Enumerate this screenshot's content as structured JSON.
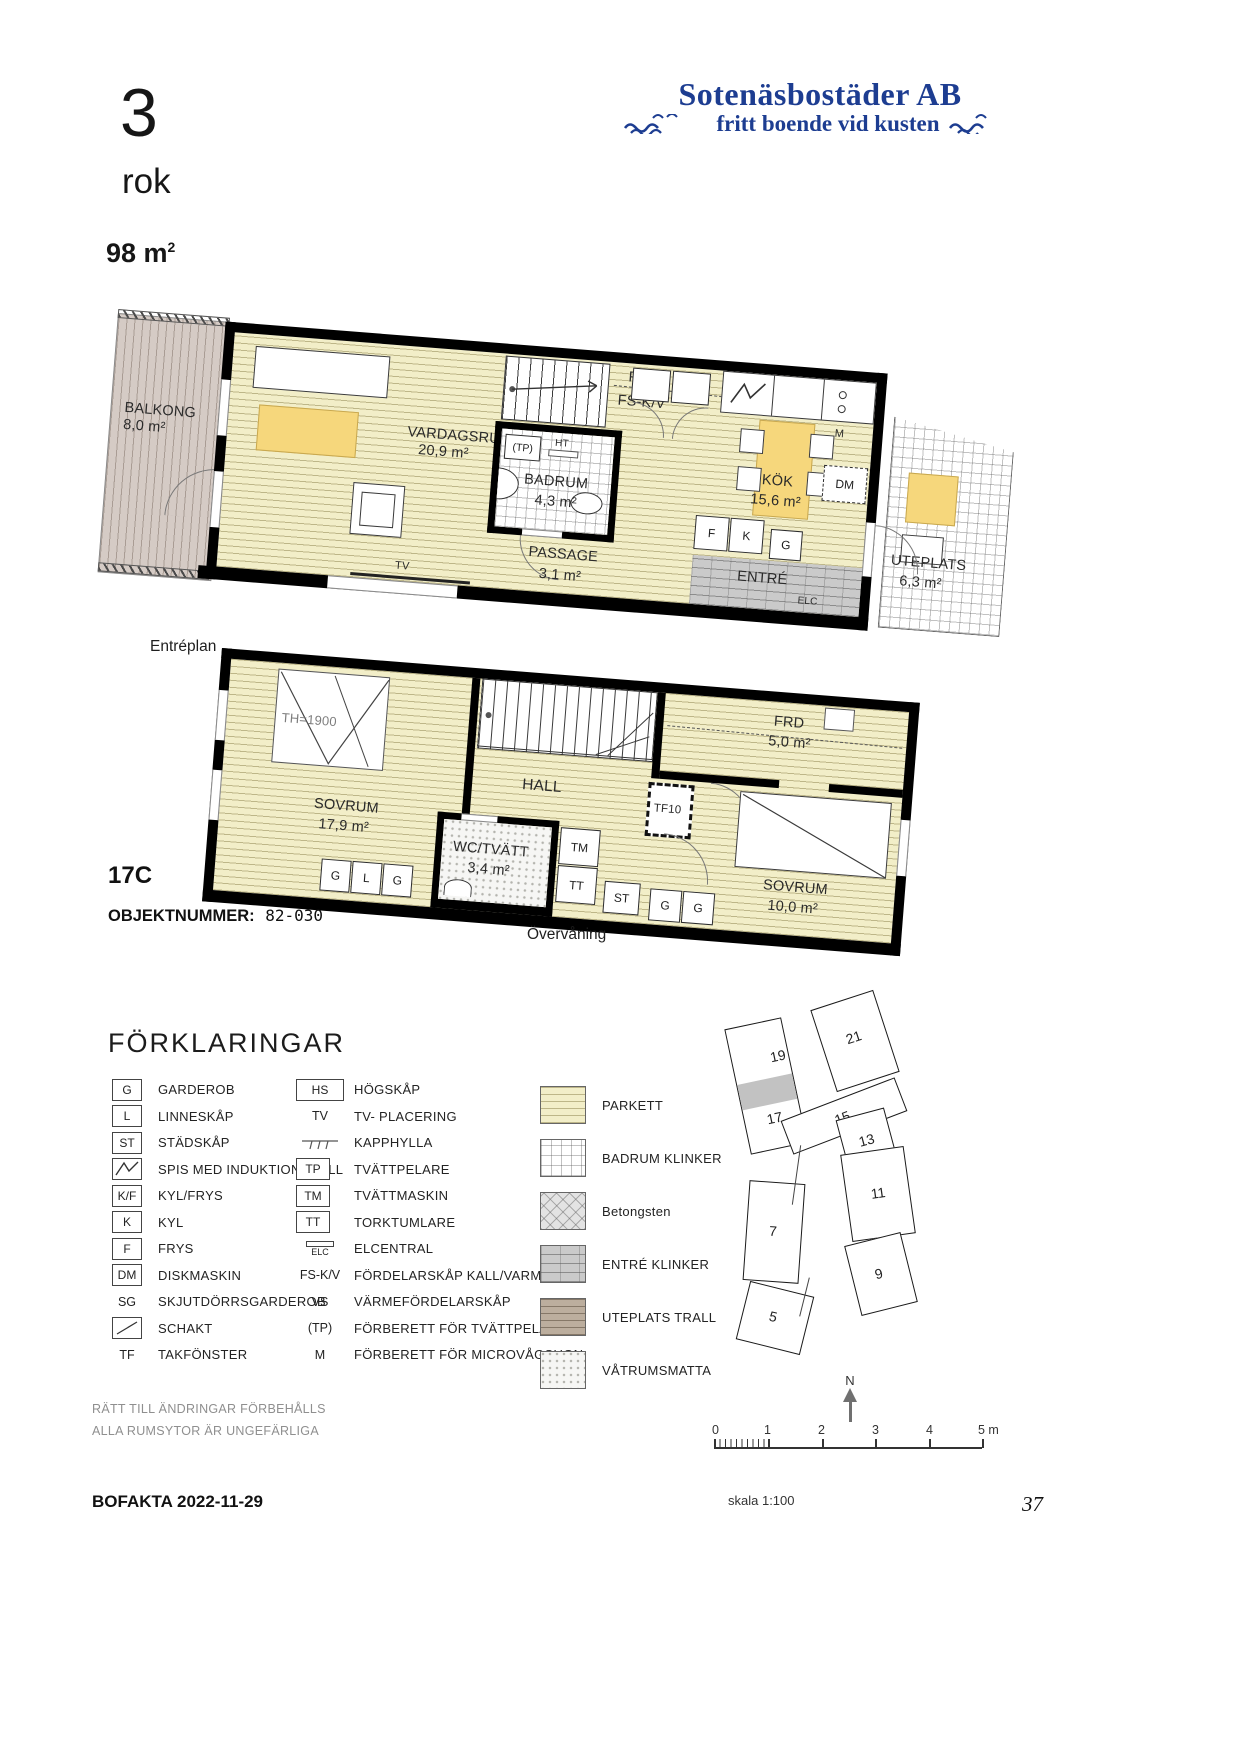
{
  "header": {
    "rooms_count": "3",
    "rooms_unit": "rok",
    "area": "98 m",
    "area_sup": "2"
  },
  "logo": {
    "line1": "Sotenäsbostäder AB",
    "line2": "fritt boende vid kusten"
  },
  "unit": {
    "id": "17C",
    "object_label": "OBJEKTNUMMER:",
    "object_number": "82-030"
  },
  "plan1": {
    "caption": "Entréplan",
    "balkong_name": "BALKONG",
    "balkong_area": "8,0 m²",
    "vardagsrum_name": "VARDAGSRUM",
    "vardagsrum_area": "20,9 m²",
    "badrum_name": "BADRUM",
    "badrum_area": "4,3 m²",
    "passage_name": "PASSAGE",
    "passage_area": "3,1 m²",
    "kok_name": "KÖK",
    "kok_area": "15,6 m²",
    "entre_name": "ENTRÉ",
    "uteplats_name": "UTEPLATS",
    "uteplats_area": "6,3 m²",
    "frd": "FRD",
    "fskv": "FS-K/V",
    "tp": "(TP)",
    "ht": "HT",
    "tv": "TV",
    "elc": "ELC",
    "m": "M",
    "dm": "DM",
    "f": "F",
    "k": "K",
    "g": "G"
  },
  "plan2": {
    "caption": "Övervåning",
    "sovrum1_name": "SOVRUM",
    "sovrum1_area": "17,9 m²",
    "hall_name": "HALL",
    "frd_name": "FRD",
    "frd_area": "5,0 m²",
    "wc_name": "WC/TVÄTT",
    "wc_area": "3,4 m²",
    "sovrum2_name": "SOVRUM",
    "sovrum2_area": "10,0 m²",
    "th": "TH=1900",
    "tf10": "TF10",
    "tm": "TM",
    "tt": "TT",
    "st": "ST",
    "g1": "G",
    "l": "L",
    "g2": "G",
    "g3": "G",
    "g4": "G"
  },
  "legend": {
    "title": "FÖRKLARINGAR",
    "col1": [
      {
        "sym": "G",
        "label": "GARDEROB"
      },
      {
        "sym": "L",
        "label": "LINNESKÅP"
      },
      {
        "sym": "ST",
        "label": "STÄDSKÅP"
      },
      {
        "sym": "",
        "label": "SPIS MED INDUKTIONSHÄLL"
      },
      {
        "sym": "K/F",
        "label": "KYL/FRYS"
      },
      {
        "sym": "K",
        "label": "KYL"
      },
      {
        "sym": "F",
        "label": "FRYS"
      },
      {
        "sym": "DM",
        "label": "DISKMASKIN"
      },
      {
        "sym": "SG",
        "label": "SKJUTDÖRRSGARDEROB"
      },
      {
        "sym": "",
        "label": "SCHAKT"
      },
      {
        "sym": "TF",
        "label": "TAKFÖNSTER"
      }
    ],
    "col2": [
      {
        "sym": "HS",
        "label": "HÖGSKÅP"
      },
      {
        "sym": "TV",
        "label": "TV- PLACERING"
      },
      {
        "sym": "",
        "label": "KAPPHYLLA"
      },
      {
        "sym": "TP",
        "label": "TVÄTTPELARE"
      },
      {
        "sym": "TM",
        "label": "TVÄTTMASKIN"
      },
      {
        "sym": "TT",
        "label": "TORKTUMLARE"
      },
      {
        "sym": "ELC",
        "label": "ELCENTRAL"
      },
      {
        "sym": "FS-K/V",
        "label": "FÖRDELARSKÅP KALL/VARM"
      },
      {
        "sym": "VS",
        "label": "VÄRMEFÖRDELARSKÅP"
      },
      {
        "sym": "(TP)",
        "label": "FÖRBERETT FÖR TVÄTTPELARE"
      },
      {
        "sym": "M",
        "label": "FÖRBERETT FÖR MICROVÅGSUGN"
      }
    ],
    "materials": [
      {
        "label": "PARKETT"
      },
      {
        "label": "BADRUM KLINKER"
      },
      {
        "label": "Betongsten"
      },
      {
        "label": "ENTRÉ KLINKER"
      },
      {
        "label": "UTEPLATS TRALL"
      },
      {
        "label": "VÅTRUMSMATTA"
      }
    ]
  },
  "site_plan": {
    "north": "N",
    "buildings": [
      {
        "label": "19"
      },
      {
        "label": "21"
      },
      {
        "label": "17"
      },
      {
        "label": "15"
      },
      {
        "label": "13"
      },
      {
        "label": "11"
      },
      {
        "label": "7"
      },
      {
        "label": "9"
      },
      {
        "label": "5"
      }
    ]
  },
  "scale": {
    "ticks": [
      "0",
      "1",
      "2",
      "3",
      "4"
    ],
    "end": "5 m",
    "caption": "skala 1:100"
  },
  "footer": {
    "line1": "RÄTT TILL ÄNDRINGAR FÖRBEHÅLLS",
    "line2": "ALLA RUMSYTOR ÄR UNGEFÄRLIGA",
    "bofakta": "BOFAKTA 2022-11-29",
    "page": "37"
  },
  "colors": {
    "logo_blue": "#1d3d91",
    "parkett": "#f2eec8",
    "accent_yellow": "#f6d77c",
    "balkong_trall": "#d5cbc5",
    "entre_gray": "#cacaca",
    "wall": "#000000"
  }
}
